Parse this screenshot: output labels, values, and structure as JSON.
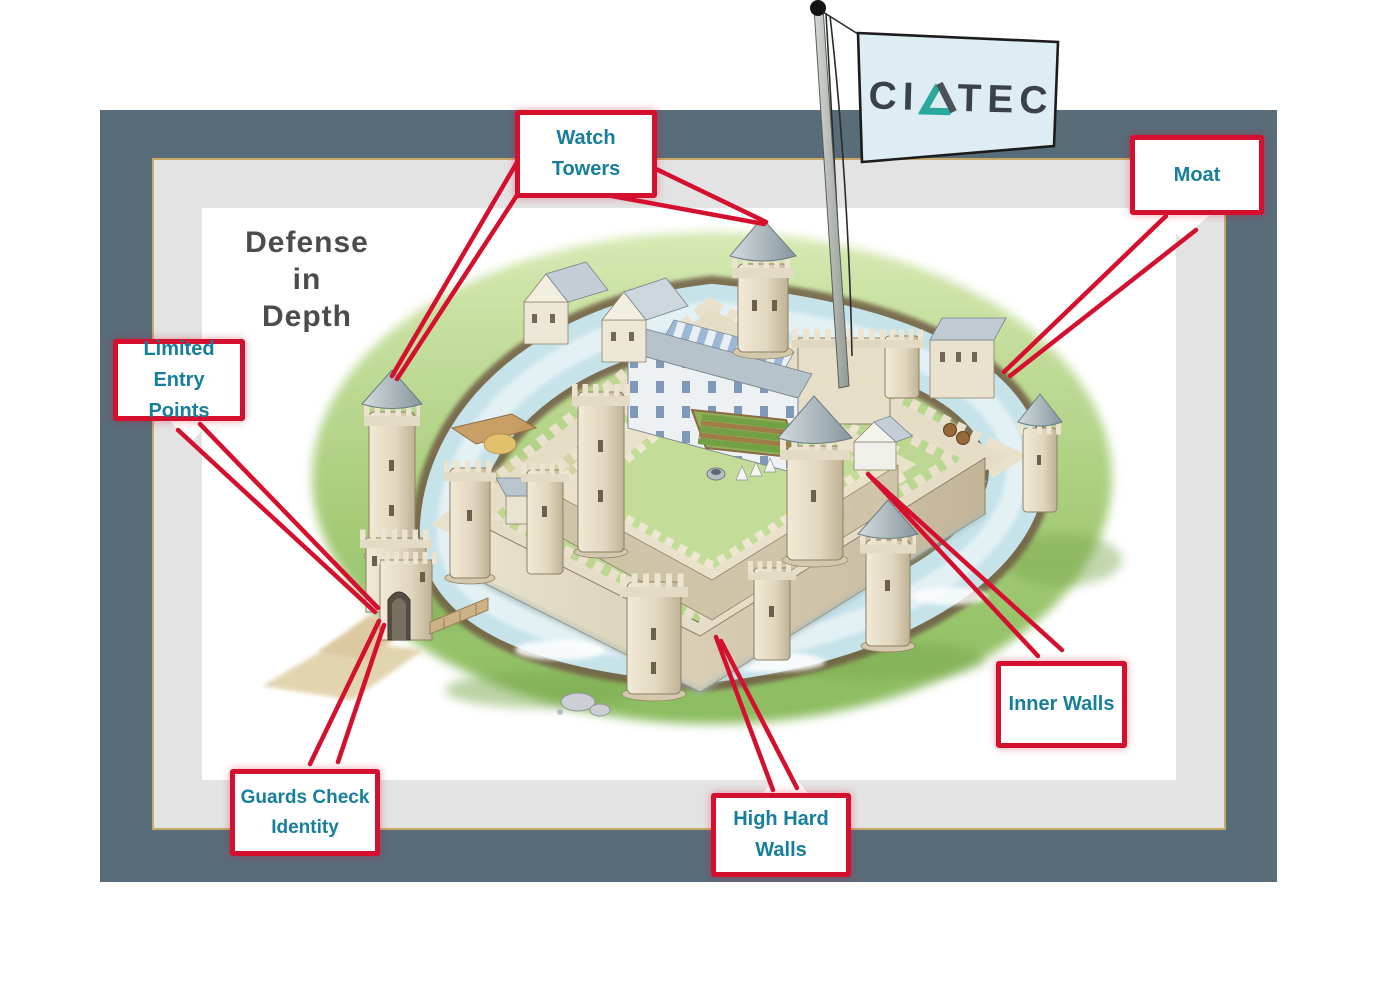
{
  "title": {
    "lines": [
      "Defense",
      "in",
      "Depth"
    ],
    "color": "#4c4c4c"
  },
  "flag": {
    "logo_left": "CI",
    "logo_right": "TEC",
    "triangle_icon": "delta-triangle",
    "flag_color": "#ddedf3",
    "logo_color": "#3a4248",
    "triangle_teal": "#2ba89e",
    "triangle_gray": "#4a5258"
  },
  "callouts": [
    {
      "id": "watch-towers",
      "text": "Watch Towers"
    },
    {
      "id": "moat",
      "text": "Moat"
    },
    {
      "id": "limited-entry-points",
      "text": "Limited Entry Points"
    },
    {
      "id": "guards-check-identity",
      "text": "Guards Check Identity"
    },
    {
      "id": "high-hard-walls",
      "text": "High Hard Walls"
    },
    {
      "id": "inner-walls",
      "text": "Inner Walls"
    }
  ],
  "style": {
    "callout_border_red": "#d50f2e",
    "callout_text_teal": "#177e9b",
    "connector_line_red": "#d50f2e",
    "frame_slate": "#596c7a",
    "mat_gray": "#e3e3e3",
    "mat_edge_gold": "#c9a967",
    "canvas_white": "#ffffff"
  },
  "illustration": {
    "subject": "moated castle, isometric view",
    "grass_green": "#a8cd7b",
    "moat_water": "#c6e3ea",
    "moat_bank_brown": "#6f5c44",
    "stone_cream": "#e3dac3",
    "stone_shadow": "#c2b598",
    "roof_gray": "#9fadb2"
  }
}
